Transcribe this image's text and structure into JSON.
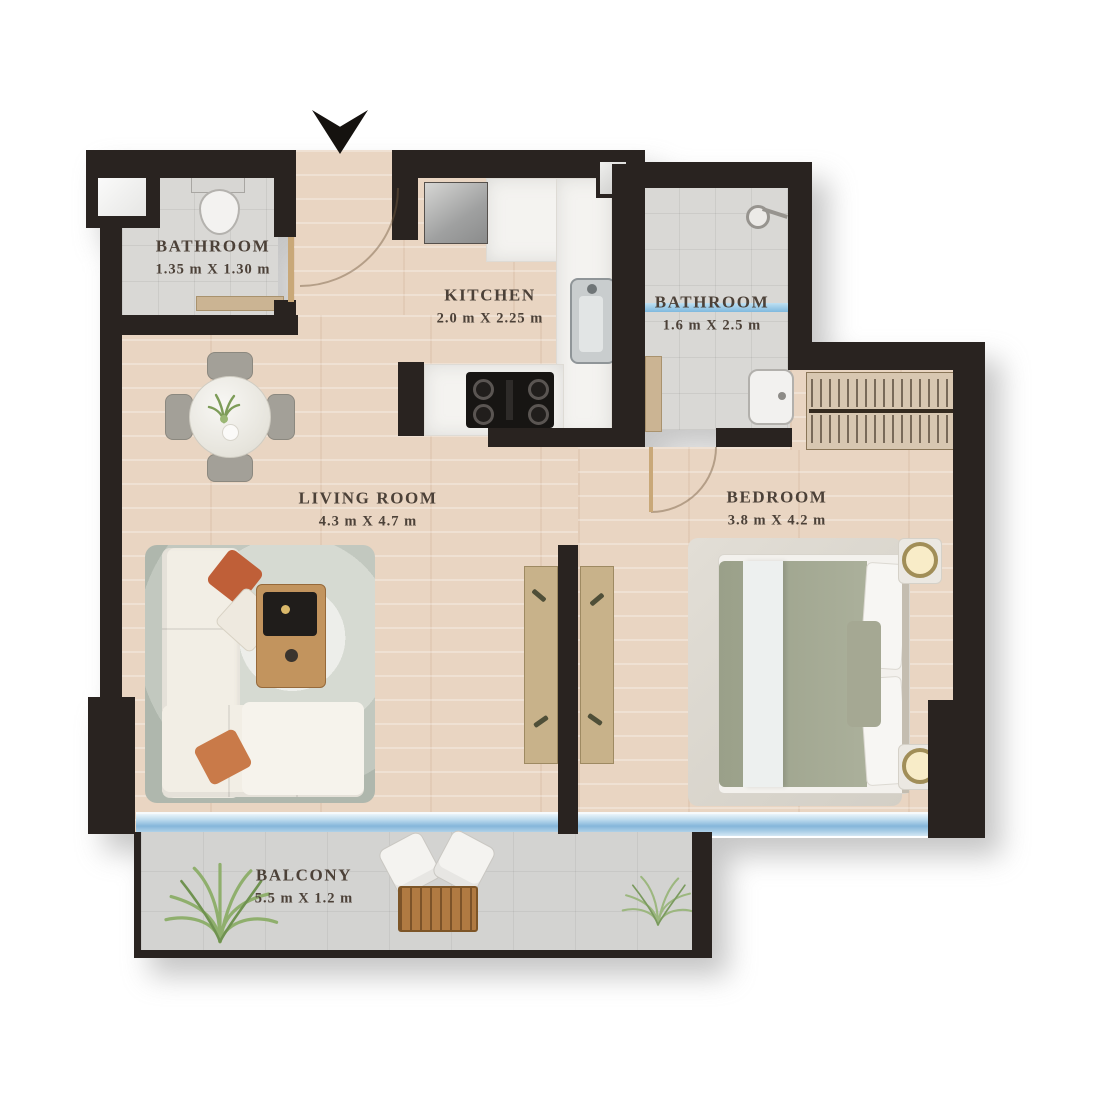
{
  "plan": {
    "type": "apartment-floor-plan",
    "entrance": {
      "marker": "entrance-arrow"
    },
    "rooms": [
      {
        "name": "BATHROOM",
        "dimensions": "1.35 m X 1.30 m"
      },
      {
        "name": "KITCHEN",
        "dimensions": "2.0 m X 2.25 m"
      },
      {
        "name": "BATHROOM",
        "dimensions": "1.6 m X 2.5 m"
      },
      {
        "name": "LIVING ROOM",
        "dimensions": "4.3 m X 4.7 m"
      },
      {
        "name": "BEDROOM",
        "dimensions": "3.8 m X 4.2 m"
      },
      {
        "name": "BALCONY",
        "dimensions": "5.5 m X 1.2 m"
      }
    ],
    "furniture": [
      "toilet",
      "vanity",
      "fridge",
      "kitchen-counter",
      "kitchen-sink",
      "stove",
      "shower-head",
      "shower-glass",
      "bathroom-sink",
      "round-dining-table",
      "dining-chairs",
      "area-rug",
      "l-shaped-sofa",
      "throw-pillows",
      "coffee-table",
      "console-table",
      "wardrobe",
      "double-bed",
      "nightstand-lamps",
      "balcony-chairs",
      "balcony-table",
      "plants"
    ],
    "colors": {
      "wall": "#292320",
      "wood_floor": "#e9d5c2",
      "tile_floor": "#d9d8d5",
      "balcony_floor": "#d3d3d1",
      "window_glass": "#85b6da",
      "counter_marble": "#f4f3f0",
      "label_text": "#4c4138",
      "accent_wood": "#b07a42",
      "accent_sage": "#a5a893",
      "accent_orange": "#bf5f38"
    }
  }
}
